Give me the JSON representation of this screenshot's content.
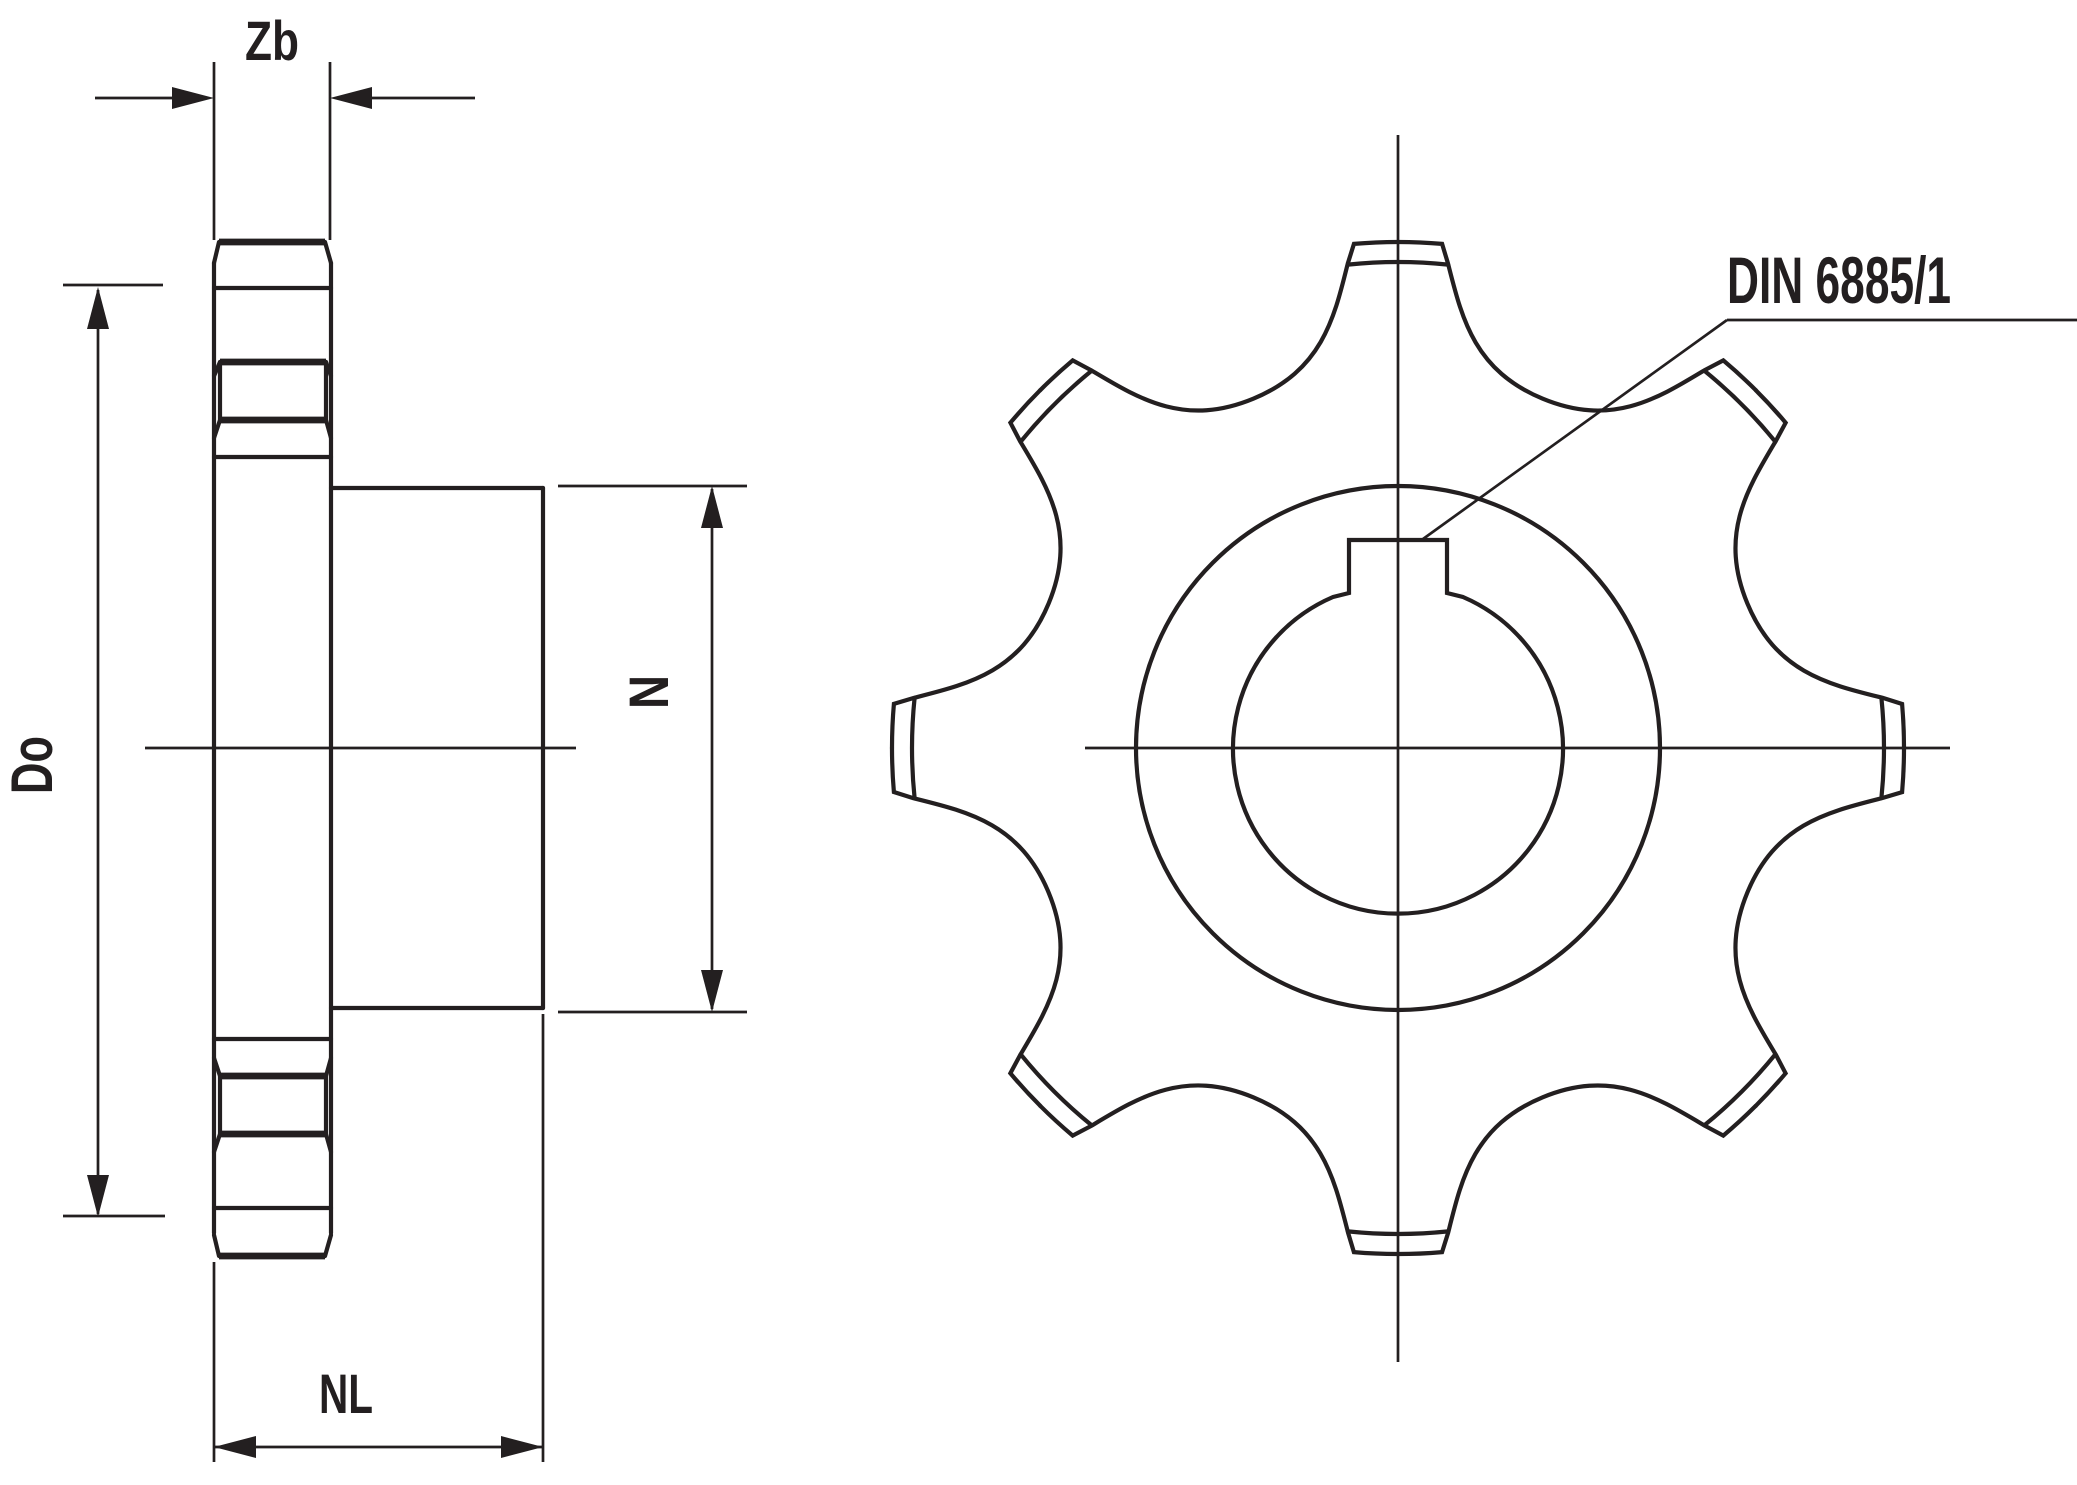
{
  "title": "Sprocket technical drawing, side section view and front view",
  "labels": {
    "tooth_width_dim": "Zb",
    "outer_diameter_dim": "Do",
    "hub_diameter_dim": "N",
    "hub_length_dim": "NL",
    "keyway_standard": "DIN 6885/1"
  },
  "drawing": {
    "type": "technical-2d-drawing",
    "views": [
      "side-section-view",
      "front-view"
    ],
    "line_color": "#231f20",
    "background_color": "#ffffff",
    "front_view": {
      "center_x": 1398,
      "center_y": 748,
      "tooth_count": 8,
      "tooth_pitch_deg": 45,
      "tip_radius": 506,
      "tip_chamfer_radius": 486,
      "gap_root_radius": 378,
      "hub_circle_radius": 262,
      "bore_radius": 165,
      "keyway_width": 98,
      "keyway_top_y": 540,
      "has_centerlines": true,
      "leader_from_keyway": true
    },
    "side_view": {
      "disc_left_x": 214,
      "disc_right_x": 331,
      "disc_top_y": 242,
      "disc_bottom_y": 1256,
      "hub_right_x": 543,
      "hub_top_y": 488,
      "hub_bottom_y": 1008,
      "center_y": 748
    }
  }
}
